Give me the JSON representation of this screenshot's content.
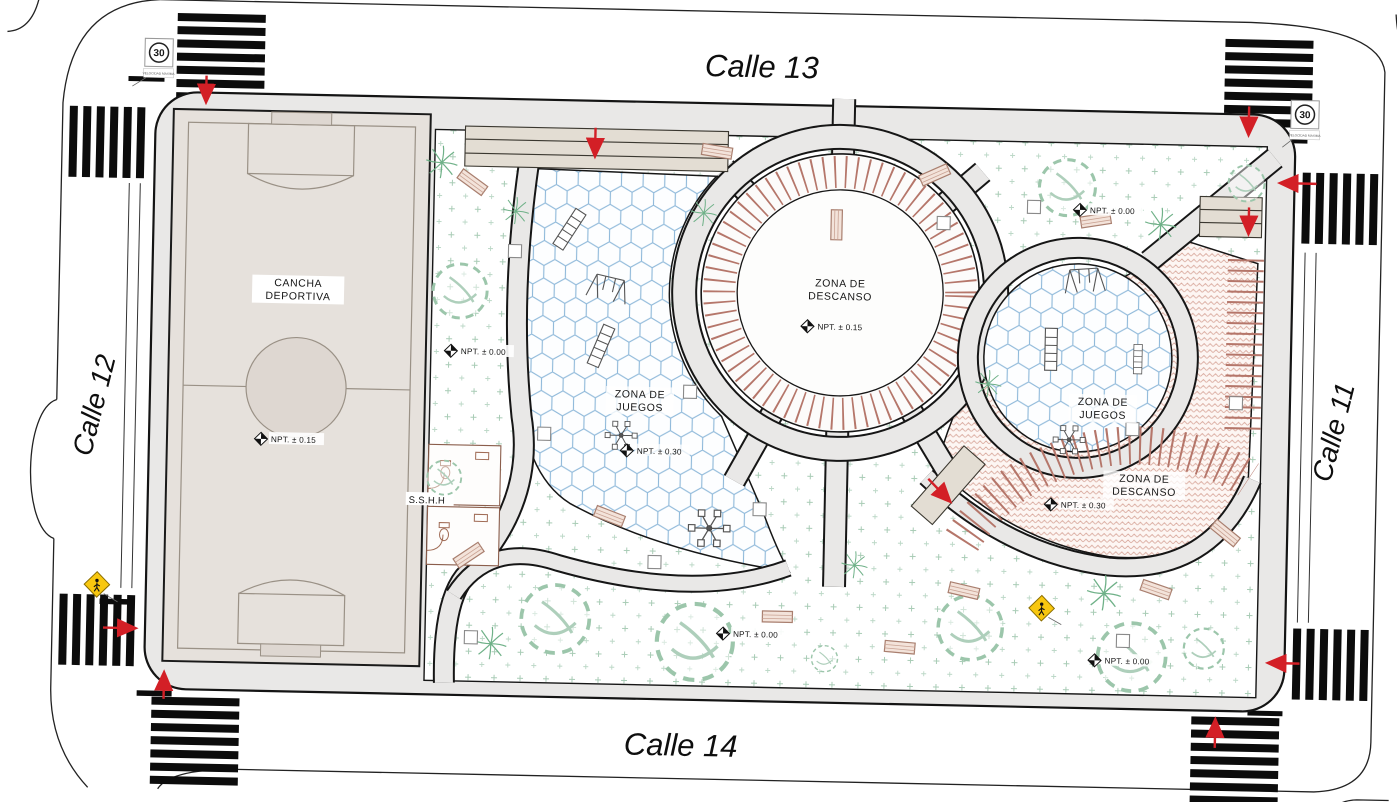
{
  "title": "Plaza site plan between Calle 11, 12, 13 and 14",
  "streets": {
    "top": "Calle 13",
    "bottom": "Calle 14",
    "left": "Calle 12",
    "right": "Calle 11"
  },
  "zones": {
    "cancha": {
      "line1": "CANCHA",
      "line2": "DEPORTIVA",
      "npt": "NPT. ± 0.15"
    },
    "central_descanso": {
      "line1": "ZONA DE",
      "line2": "DESCANSO",
      "npt": "NPT. ± 0.15"
    },
    "left_juegos": {
      "line1": "ZONA DE",
      "line2": "JUEGOS",
      "npt": "NPT. ± 0.30"
    },
    "right_juegos": {
      "line1": "ZONA DE",
      "line2": "JUEGOS"
    },
    "right_descanso": {
      "line1": "ZONA DE",
      "line2": "DESCANSO",
      "npt": "NPT. ± 0.30"
    },
    "restrooms": {
      "label": "S.S.H.H"
    }
  },
  "markers": {
    "left_green": "NPT. ± 0.00",
    "top_right_green": "NPT. ± 0.00",
    "bottom_center_green": "NPT. ± 0.00",
    "bottom_right_green": "NPT. ± 0.00"
  },
  "signs": {
    "speed_limit": "30",
    "speed_caption": "VELOCIDAD MAXIMA"
  },
  "colors": {
    "path_gray": "#e9e8e7",
    "field_beige": "#e6e1dc",
    "hex_paving_blue": "#8fb9da",
    "brick_pink": "#d9a99d",
    "pergola_brown": "#b5766a",
    "grass_green": "#a9ccb6",
    "arrow_red": "#d31f26",
    "sign_yellow": "#f8c70f",
    "line_black": "#161616"
  }
}
